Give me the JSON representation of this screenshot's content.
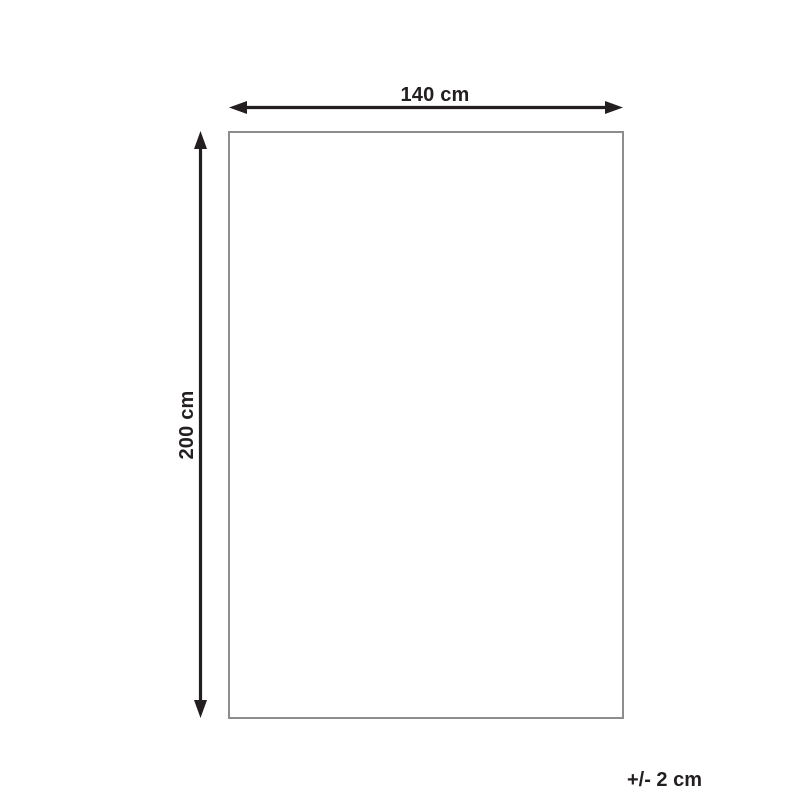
{
  "diagram": {
    "width_label": "140 cm",
    "height_label": "200 cm",
    "tolerance_label": "+/- 2 cm",
    "colors": {
      "line": "#231f20",
      "outline": "#8d8d8d",
      "background": "#ffffff"
    }
  }
}
